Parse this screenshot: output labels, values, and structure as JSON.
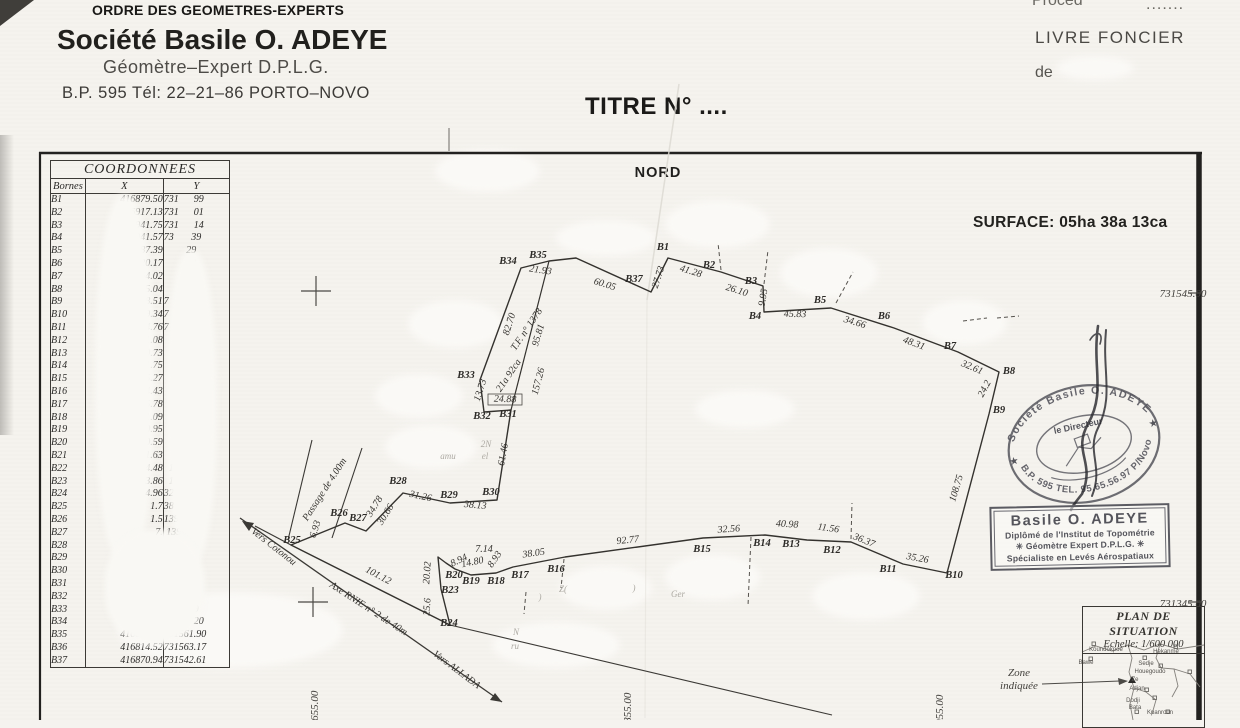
{
  "letterhead": {
    "order": "ORDRE DES GEOMETRES-EXPERTS",
    "company": "Société Basile O. ADEYE",
    "profession": "Géomètre–Expert  D.P.L.G.",
    "contact": "B.P. 595 Tél: 22–21–86 PORTO–NOVO"
  },
  "registry": {
    "procedure": "Procéd",
    "procedure_dots": ".......",
    "livre_foncier": "LIVRE  FONCIER",
    "de_label": "de"
  },
  "title": "TITRE N° ....",
  "north_label": "NORD",
  "surface_label": "SURFACE: 05ha 38a 13ca",
  "table": {
    "title": "COORDONNEES",
    "columns": [
      "Bornes",
      "X",
      "Y"
    ],
    "rows": [
      {
        "b": "B1",
        "x": "416879.50",
        "y": "731      99"
      },
      {
        "b": "B2",
        "x": "16917.13",
        "y": "731      01"
      },
      {
        "b": "B3",
        "x": "16941.75",
        "y": "731      14"
      },
      {
        "b": "B4",
        "x": "6941.57",
        "y": "73       39"
      },
      {
        "b": "B5",
        "x": "6987.39",
        "y": "         29"
      },
      {
        "b": "B6",
        "x": "020.17",
        "y": "         03"
      },
      {
        "b": "B7",
        "x": "64.02",
        "y": "         76"
      },
      {
        "b": "B8",
        "x": "5.04",
        "y": "         69"
      },
      {
        "b": "B9",
        "x": "8.51",
        "y": "7      .35"
      },
      {
        "b": "B10",
        "x": "9.34",
        "y": "7       59"
      },
      {
        "b": "B11",
        "x": "4.76",
        "y": "7       46"
      },
      {
        "b": "B12",
        "x": "1.08",
        "y": "         00"
      },
      {
        "b": "B13",
        "x": "0.73",
        "y": "          9"
      },
      {
        "b": "B14",
        "x": "1.75",
        "y": "          1"
      },
      {
        "b": "B15",
        "x": "5.27",
        "y": "          1"
      },
      {
        "b": "B16",
        "x": "4.43",
        "y": ""
      },
      {
        "b": "B17",
        "x": "5.78",
        "y": ""
      },
      {
        "b": "B18",
        "x": "1.09",
        "y": ""
      },
      {
        "b": "B19",
        "x": "0.95",
        "y": ""
      },
      {
        "b": "B20",
        "x": "0.59",
        "y": ""
      },
      {
        "b": "B21",
        "x": "1.63",
        "y": ""
      },
      {
        "b": "B22",
        "x": "4.48",
        "y": "  1"
      },
      {
        "b": "B23",
        "x": "3.86",
        "y": "  1"
      },
      {
        "b": "B24",
        "x": "4.96",
        "y": "32"
      },
      {
        "b": "B25",
        "x": "1.7",
        "y": "38"
      },
      {
        "b": "B26",
        "x": "1.5",
        "y": "139"
      },
      {
        "b": "B27",
        "x": "7.",
        "y": " 139"
      },
      {
        "b": "B28",
        "x": "",
        "y": "3147"
      },
      {
        "b": "B29",
        "x": "",
        "y": "314"
      },
      {
        "b": "B30",
        "x": "",
        "y": "31"
      },
      {
        "b": "B31",
        "x": "",
        "y": "73"
      },
      {
        "b": "B32",
        "x": "",
        "y": "7"
      },
      {
        "b": "B33",
        "x": "",
        "y": "73        9"
      },
      {
        "b": "B34",
        "x": "4        61",
        "y": "731      20"
      },
      {
        "b": "B35",
        "x": "416812.50",
        "y": "731561.90"
      },
      {
        "b": "B36",
        "x": "416814.52",
        "y": "731563.17"
      },
      {
        "b": "B37",
        "x": "416870.94",
        "y": "731542.61"
      }
    ]
  },
  "grid": {
    "labels": [
      {
        "t": "731545.00",
        "x": 1183,
        "y": 297,
        "a": "end"
      },
      {
        "t": "731345.00",
        "x": 1183,
        "y": 607,
        "a": "end"
      },
      {
        "t": "416655.00",
        "x": 318,
        "y": 714,
        "r": -90,
        "a": "start"
      },
      {
        "t": "416855.00",
        "x": 631,
        "y": 716,
        "r": -90,
        "a": "start"
      },
      {
        "t": "417055.00",
        "x": 943,
        "y": 718,
        "r": -90,
        "a": "start"
      }
    ]
  },
  "parcel": {
    "dimensions": [
      {
        "t": "21.93",
        "x": 540,
        "y": 273,
        "r": 8
      },
      {
        "t": "60.05",
        "x": 604,
        "y": 287,
        "r": 17
      },
      {
        "t": "27.73",
        "x": 661,
        "y": 278,
        "r": -72
      },
      {
        "t": "41.28",
        "x": 690,
        "y": 274,
        "r": 17
      },
      {
        "t": "26.10",
        "x": 736,
        "y": 293,
        "r": 17
      },
      {
        "t": "9.95",
        "x": 766,
        "y": 298,
        "r": -80
      },
      {
        "t": "45.83",
        "x": 795,
        "y": 317,
        "r": 1
      },
      {
        "t": "34.66",
        "x": 854,
        "y": 325,
        "r": 17
      },
      {
        "t": "48.31",
        "x": 913,
        "y": 346,
        "r": 20
      },
      {
        "t": "32.61",
        "x": 971,
        "y": 370,
        "r": 23
      },
      {
        "t": "24.2",
        "x": 987,
        "y": 390,
        "r": -62
      },
      {
        "t": "108.75",
        "x": 959,
        "y": 489,
        "r": -73
      },
      {
        "t": "35.26",
        "x": 917,
        "y": 561,
        "r": 10
      },
      {
        "t": "36.37",
        "x": 863,
        "y": 543,
        "r": 22
      },
      {
        "t": "11.56",
        "x": 828,
        "y": 531,
        "r": 8
      },
      {
        "t": "40.98",
        "x": 787,
        "y": 527,
        "r": 3
      },
      {
        "t": "32.56",
        "x": 729,
        "y": 532,
        "r": -4
      },
      {
        "t": "92.77",
        "x": 628,
        "y": 543,
        "r": -6
      },
      {
        "t": "38.05",
        "x": 534,
        "y": 556,
        "r": -8
      },
      {
        "t": "7.14",
        "x": 484,
        "y": 552,
        "r": 0,
        "s": 7.5
      },
      {
        "t": "8.94",
        "x": 460,
        "y": 563,
        "r": -25,
        "s": 7
      },
      {
        "t": "14.80",
        "x": 473,
        "y": 565,
        "r": -12,
        "s": 7
      },
      {
        "t": "8.93",
        "x": 497,
        "y": 561,
        "r": -55,
        "s": 7
      },
      {
        "t": "20.02",
        "x": 430,
        "y": 573,
        "r": -86
      },
      {
        "t": "25.6",
        "x": 430,
        "y": 607,
        "r": -86
      },
      {
        "t": "101.12",
        "x": 377,
        "y": 578,
        "r": 28
      },
      {
        "t": "6.93",
        "x": 318,
        "y": 530,
        "r": -72
      },
      {
        "t": "34.78",
        "x": 377,
        "y": 508,
        "r": -58
      },
      {
        "t": "30.66",
        "x": 388,
        "y": 516,
        "r": -58
      },
      {
        "t": "31.26",
        "x": 420,
        "y": 499,
        "r": 12
      },
      {
        "t": "38.13",
        "x": 475,
        "y": 508,
        "r": 5
      },
      {
        "t": "61.46",
        "x": 506,
        "y": 455,
        "r": -80
      },
      {
        "t": "24.88",
        "x": 505,
        "y": 402,
        "r": 2
      },
      {
        "t": "13.73",
        "x": 483,
        "y": 391,
        "r": -72
      },
      {
        "t": "82.70",
        "x": 512,
        "y": 325,
        "r": -72
      },
      {
        "t": "95.81",
        "x": 541,
        "y": 336,
        "r": -73
      },
      {
        "t": "157.26",
        "x": 541,
        "y": 382,
        "r": -75
      },
      {
        "t": "T.F. n° 1378",
        "x": 529,
        "y": 331,
        "r": -56
      },
      {
        "t": "21a 92ca",
        "x": 511,
        "y": 377,
        "r": -56
      },
      {
        "t": "Vers Cotonou",
        "x": 272,
        "y": 549,
        "r": 38,
        "s": 11,
        "n": "road-label-vers-cotonou"
      },
      {
        "t": "Axe RNIE n° 2 de 40m",
        "x": 367,
        "y": 611,
        "r": 33,
        "s": 11,
        "n": "road-label-axe-rnie"
      },
      {
        "t": "Vers ALLADA",
        "x": 455,
        "y": 672,
        "r": 37,
        "s": 11,
        "n": "road-label-vers-allada"
      },
      {
        "t": "Passage de 4.00m",
        "x": 327,
        "y": 491,
        "r": -57,
        "s": 11,
        "n": "road-label-passage"
      }
    ],
    "vertices": [
      {
        "t": "B1",
        "x": 663,
        "y": 250
      },
      {
        "t": "B2",
        "x": 709,
        "y": 268
      },
      {
        "t": "B3",
        "x": 751,
        "y": 284
      },
      {
        "t": "B4",
        "x": 755,
        "y": 319
      },
      {
        "t": "B5",
        "x": 820,
        "y": 303
      },
      {
        "t": "B6",
        "x": 884,
        "y": 319
      },
      {
        "t": "B7",
        "x": 950,
        "y": 349
      },
      {
        "t": "B8",
        "x": 1009,
        "y": 374
      },
      {
        "t": "B9",
        "x": 999,
        "y": 413
      },
      {
        "t": "B10",
        "x": 954,
        "y": 578
      },
      {
        "t": "B11",
        "x": 888,
        "y": 572
      },
      {
        "t": "B12",
        "x": 832,
        "y": 553
      },
      {
        "t": "B13",
        "x": 791,
        "y": 547
      },
      {
        "t": "B14",
        "x": 762,
        "y": 546
      },
      {
        "t": "B15",
        "x": 702,
        "y": 552
      },
      {
        "t": "B16",
        "x": 556,
        "y": 572
      },
      {
        "t": "B17",
        "x": 520,
        "y": 578
      },
      {
        "t": "B18",
        "x": 496,
        "y": 584
      },
      {
        "t": "B19",
        "x": 471,
        "y": 584
      },
      {
        "t": "B20",
        "x": 454,
        "y": 578
      },
      {
        "t": "B23",
        "x": 450,
        "y": 593
      },
      {
        "t": "B24",
        "x": 449,
        "y": 626
      },
      {
        "t": "B25",
        "x": 292,
        "y": 543
      },
      {
        "t": "B26",
        "x": 339,
        "y": 516
      },
      {
        "t": "B27",
        "x": 358,
        "y": 521
      },
      {
        "t": "B28",
        "x": 398,
        "y": 484
      },
      {
        "t": "B29",
        "x": 449,
        "y": 498
      },
      {
        "t": "B30",
        "x": 491,
        "y": 495
      },
      {
        "t": "B31",
        "x": 508,
        "y": 417
      },
      {
        "t": "B32",
        "x": 482,
        "y": 419
      },
      {
        "t": "B33",
        "x": 466,
        "y": 378
      },
      {
        "t": "B34",
        "x": 508,
        "y": 264
      },
      {
        "t": "B35",
        "x": 538,
        "y": 258
      },
      {
        "t": "B37",
        "x": 634,
        "y": 282
      }
    ],
    "fragments": [
      {
        "t": "Z(",
        "x": 563,
        "y": 592
      },
      {
        "t": ")",
        "x": 634,
        "y": 591
      },
      {
        "t": ")",
        "x": 540,
        "y": 600
      },
      {
        "t": "Ger",
        "x": 678,
        "y": 597
      },
      {
        "t": "N",
        "x": 516,
        "y": 635
      },
      {
        "t": "ru",
        "x": 515,
        "y": 649
      },
      {
        "t": "2N",
        "x": 486,
        "y": 447
      },
      {
        "t": "amu",
        "x": 448,
        "y": 459
      },
      {
        "t": "el",
        "x": 485,
        "y": 459
      }
    ]
  },
  "stamps": {
    "oval": {
      "top": "Société Basile O. ADEYE",
      "center": "le Directeur",
      "bottom": "B.P. 595 TEL. 95.65.56.97 P/Novo",
      "star_left": "★",
      "star_right": "★"
    },
    "rect": {
      "line1": "Basile O. ADEYE",
      "line2": "Diplômé de l'Institut de Topométrie",
      "line3": "✳  Géomètre Expert D.P.L.G.  ✳",
      "line4": "Spécialiste en Levés Aérospatiaux"
    }
  },
  "situation": {
    "title": "PLAN DE SITUATION",
    "scale": "Echelle: 1/600 000",
    "zone_line1": "Zone",
    "zone_line2": "indiquée",
    "places": [
      {
        "t": "Koundokpoe",
        "x": 1106,
        "y": 651
      },
      {
        "t": "Hekanme",
        "x": 1166,
        "y": 653
      },
      {
        "t": "Bawe",
        "x": 1086,
        "y": 664
      },
      {
        "t": "Sedje",
        "x": 1146,
        "y": 665
      },
      {
        "t": "Houegoudo",
        "x": 1150,
        "y": 673
      },
      {
        "t": "Ze",
        "x": 1135,
        "y": 681
      },
      {
        "t": "Adjan",
        "x": 1137,
        "y": 690
      },
      {
        "t": "Dodji",
        "x": 1133,
        "y": 702
      },
      {
        "t": "Bata",
        "x": 1135,
        "y": 709
      },
      {
        "t": "Kpanroun",
        "x": 1160,
        "y": 714
      }
    ]
  }
}
